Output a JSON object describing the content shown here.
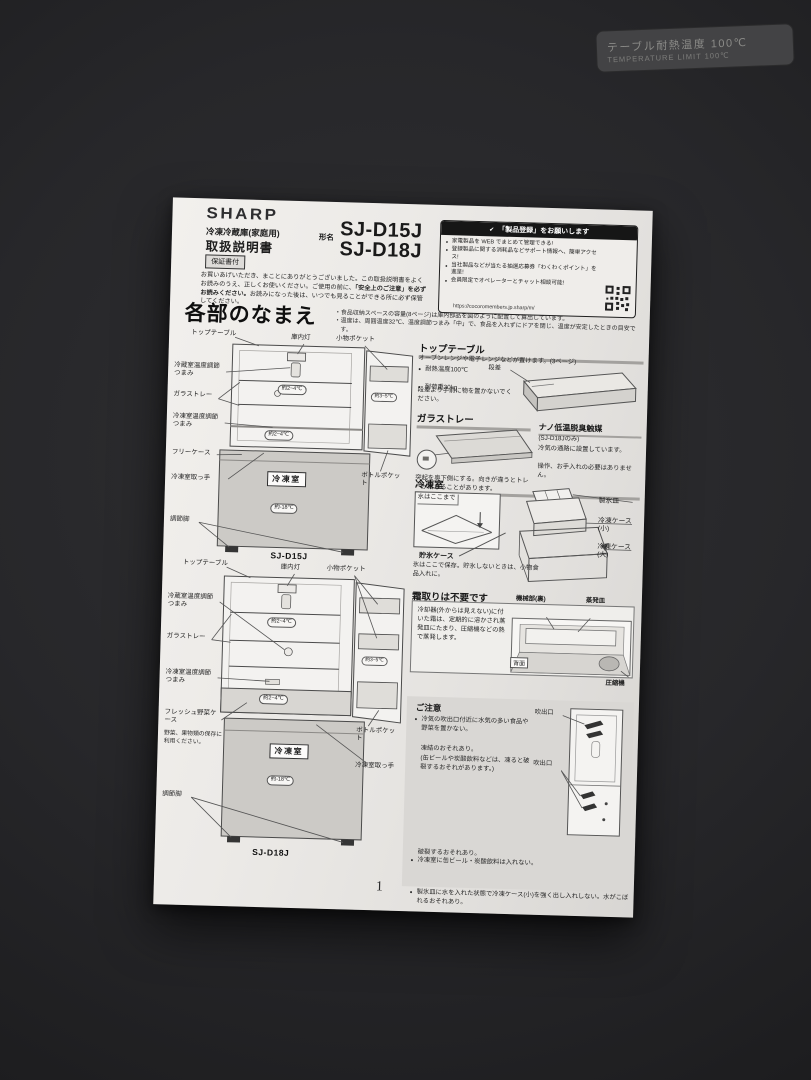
{
  "surface_label": {
    "line1": "テーブル耐熱温度 100℃",
    "line2": "TEMPERATURE LIMIT 100℃"
  },
  "header": {
    "brand": "SHARP",
    "category": "冷凍冷蔵庫(家庭用)",
    "model_prefix": "形名",
    "models": [
      "SJ-D15J",
      "SJ-D18J"
    ],
    "doc_title": "取扱説明書",
    "warranty_badge": "保証書付",
    "intro_1": "お買いあげいただき、まことにありがとうございました。この取扱説明書をよくお読みのうえ、正しくお使いください。ご使用の前に、",
    "intro_bold": "「安全上のご注意」を必ずお読みください。",
    "intro_2": "お読みになった後は、いつでも見ることができる所に必ず保管してください。"
  },
  "registration": {
    "icon": "✔",
    "title": "「製品登録」をお願いします",
    "bullets": [
      "家電製品を WEB でまとめて管理できる!",
      "登録製品に関する消耗品などサポート情報へ、簡単アクセス!",
      "当社製品などが当たる抽選応募券「わくわくポイント」を進呈!",
      "会員限定でオペレーターとチャット相談可能!"
    ],
    "url": "https://cocoromembers.jp.sharp/m/"
  },
  "page": {
    "section_title": "各部のなまえ",
    "notes": [
      "食品収納スペースの容量(8ページ)は庫内部品を図のように配置して算出しています。",
      "温度は、周囲温度32℃、温度調節つまみ「中」で、食品を入れずにドアを閉じ、温度が安定したときの目安です。"
    ],
    "number": "1"
  },
  "diagram1": {
    "caption": "SJ-D15J",
    "labels": {
      "top_table": "トップテーブル",
      "lamp": "庫内灯",
      "small_pocket": "小物ポケット",
      "fridge_knob": "冷蔵室温度調節つまみ",
      "glass_tray": "ガラストレー",
      "freezer_knob": "冷凍室温度調節つまみ",
      "free_case": "フリーケース",
      "freezer_handle": "冷凍室取っ手",
      "feet": "調節脚",
      "bottle_pocket": "ボトルポケット",
      "freezer_room": "冷凍室"
    },
    "temps": {
      "upper": "約2~4℃",
      "door": "約3~5℃",
      "lower": "約2~4℃",
      "freezer": "約-18℃"
    }
  },
  "diagram2": {
    "caption": "SJ-D18J",
    "labels": {
      "top_table": "トップテーブル",
      "lamp": "庫内灯",
      "small_pocket": "小物ポケット",
      "fridge_knob": "冷蔵室温度調節つまみ",
      "glass_tray": "ガラストレー",
      "freezer_knob": "冷凍室温度調節つまみ",
      "veg_case": "フレッシュ野菜ケース",
      "veg_note": "野菜、果物類の保存に利用ください。",
      "feet": "調節脚",
      "bottle_pocket": "ボトルポケット",
      "freezer_handle": "冷凍室取っ手",
      "freezer_room": "冷凍室"
    },
    "temps": {
      "upper": "約2~4℃",
      "door": "約3~5℃",
      "lower": "約2~4℃",
      "freezer": "約-18℃"
    }
  },
  "sections": {
    "top_table": {
      "title": "トップテーブル",
      "desc": "オーブンレンジや電子レンジなどが置けます。(3ページ)",
      "bullets": [
        "耐熱温度100℃",
        "耐荷重30kg"
      ],
      "note": "段差より手前に物を置かないでください。",
      "step_label": "段差"
    },
    "glass_tray": {
      "title": "ガラストレー",
      "note": "突起を奥下側にする。向きが違うとトレーが落ちることがあります。"
    },
    "nano": {
      "title": "ナノ低温脱臭触媒",
      "lines": [
        "(SJ-D18Jのみ)",
        "冷気の通路に設置しています。",
        "操作、お手入れの必要はありません。"
      ]
    },
    "freezer": {
      "title": "冷凍室",
      "water_label": "水はここまで",
      "ice_tray": "製氷皿",
      "case_small": "冷凍ケース(小)",
      "case_large": "冷凍ケース(大)",
      "storage_label": "貯氷ケース",
      "storage_note": "氷はここで保存。貯氷しないときは、小物食品入れに。"
    },
    "defrost": {
      "title": "霜取りは不要です",
      "body": "冷却器(外からは見えない)に付いた霜は、定期的に溶かされ蒸発皿にたまり、圧縮機などの熱で蒸発します。",
      "machine_label": "機械部(裏)",
      "evap_label": "蒸発皿",
      "back_label": "背面",
      "compressor_label": "圧縮機"
    },
    "caution": {
      "title": "ご注意",
      "vent_label": "吹出口",
      "items": [
        {
          "main": "冷気の吹出口付近に水気の多い食品や野菜を置かない。",
          "sub": "凍結のおそれあり。",
          "paren": "(缶ビールや炭酸飲料などは、凍ると破裂するおそれがあります。)"
        },
        {
          "main": "冷凍室に缶ビール・炭酸飲料は入れない。",
          "sub": "破裂するおそれあり。"
        },
        {
          "main": "製氷皿に水を入れた状態で冷凍ケース(小)を強く出し入れしない。水がこぼれるおそれあり。"
        }
      ]
    }
  }
}
